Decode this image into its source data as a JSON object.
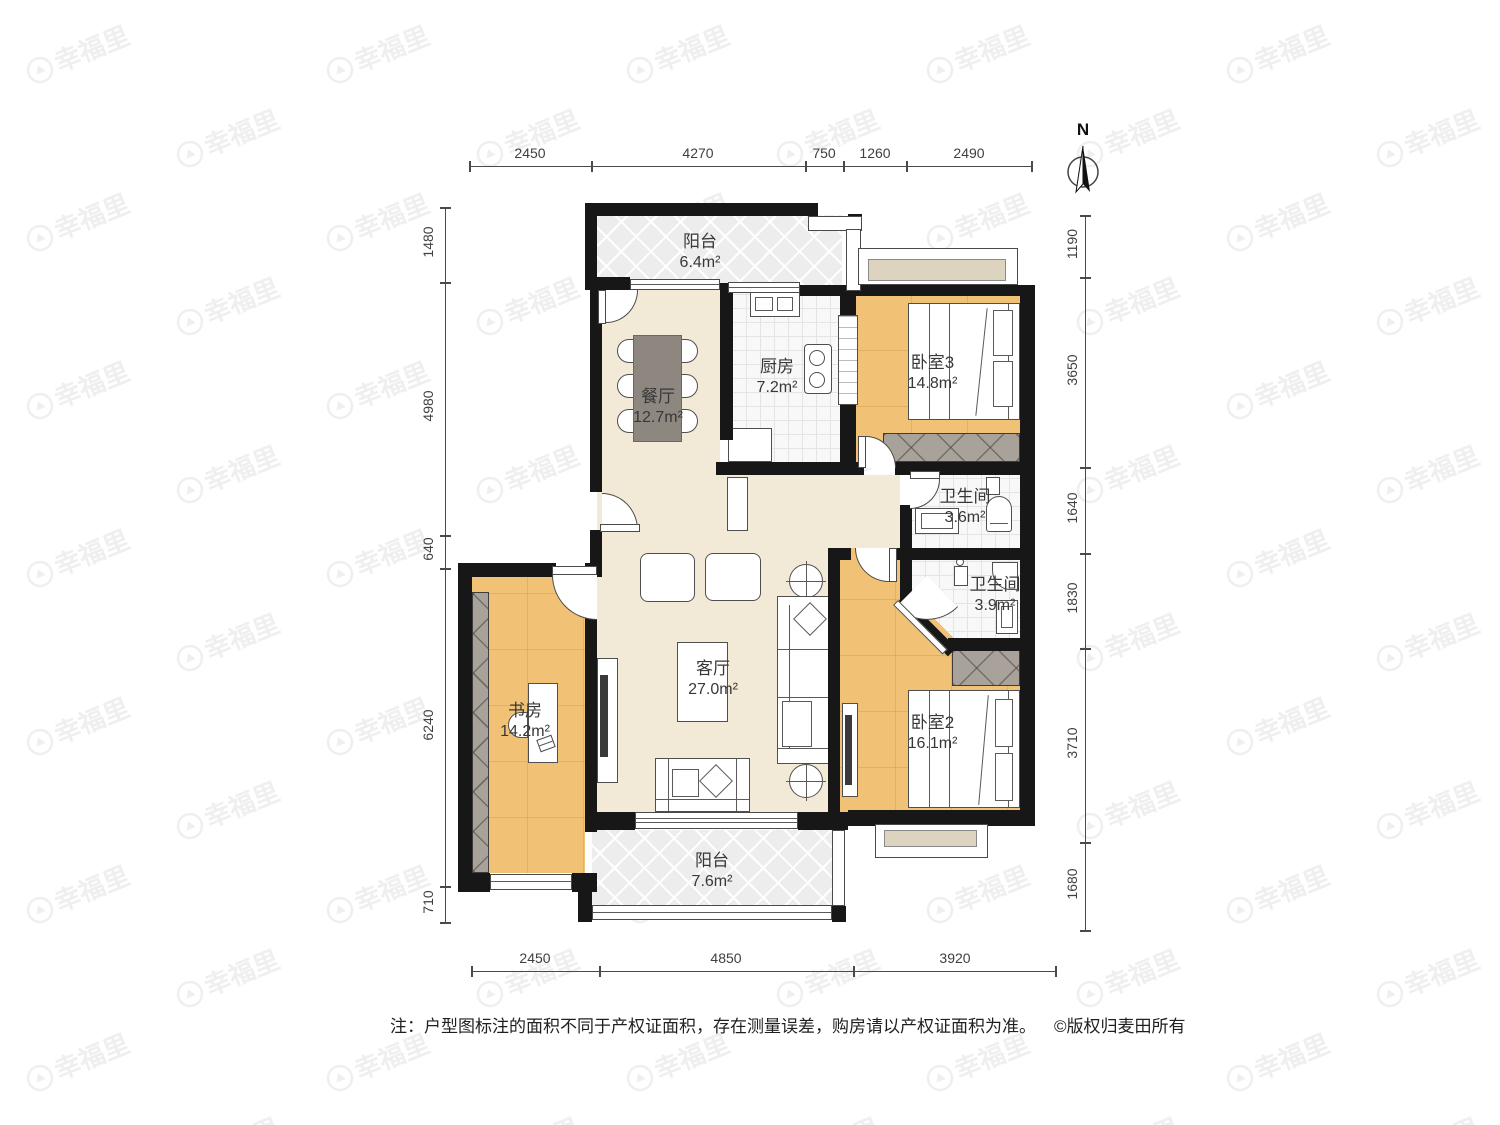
{
  "watermark": {
    "brand": "幸福里"
  },
  "north": {
    "label": "N"
  },
  "rooms": {
    "balcony_top": {
      "name": "阳台",
      "area": "6.4m²"
    },
    "dining": {
      "name": "餐厅",
      "area": "12.7m²"
    },
    "kitchen": {
      "name": "厨房",
      "area": "7.2m²"
    },
    "bedroom3": {
      "name": "卧室3",
      "area": "14.8m²"
    },
    "bath_top": {
      "name": "卫生间",
      "area": "3.6m²"
    },
    "bath_bottom": {
      "name": "卫生间",
      "area": "3.9m²"
    },
    "living": {
      "name": "客厅",
      "area": "27.0m²"
    },
    "study": {
      "name": "书房",
      "area": "14.2m²"
    },
    "bedroom2": {
      "name": "卧室2",
      "area": "16.1m²"
    },
    "balcony_bottom": {
      "name": "阳台",
      "area": "7.6m²"
    }
  },
  "dimensions": {
    "top": [
      "2450",
      "4270",
      "750",
      "1260",
      "2490"
    ],
    "bottom": [
      "2450",
      "4850",
      "3920"
    ],
    "left": [
      "1480",
      "4980",
      "640",
      "6240",
      "710"
    ],
    "right": [
      "1190",
      "3650",
      "1640",
      "1830",
      "3710",
      "1680"
    ]
  },
  "footer": {
    "note": "注：户型图标注的面积不同于产权证面积，存在测量误差，购房请以产权证面积为准。",
    "copyright": "©版权归麦田所有"
  },
  "colors": {
    "wall": "#171717",
    "wood_floor": "#f1c276",
    "cream_floor": "#f3e9d7",
    "tile_floor": "#f8f8f8",
    "balcony_floor": "#ededed",
    "wardrobe": "#a8a29b",
    "table": "#8d8780",
    "bay_sill": "#ddd4bf"
  }
}
